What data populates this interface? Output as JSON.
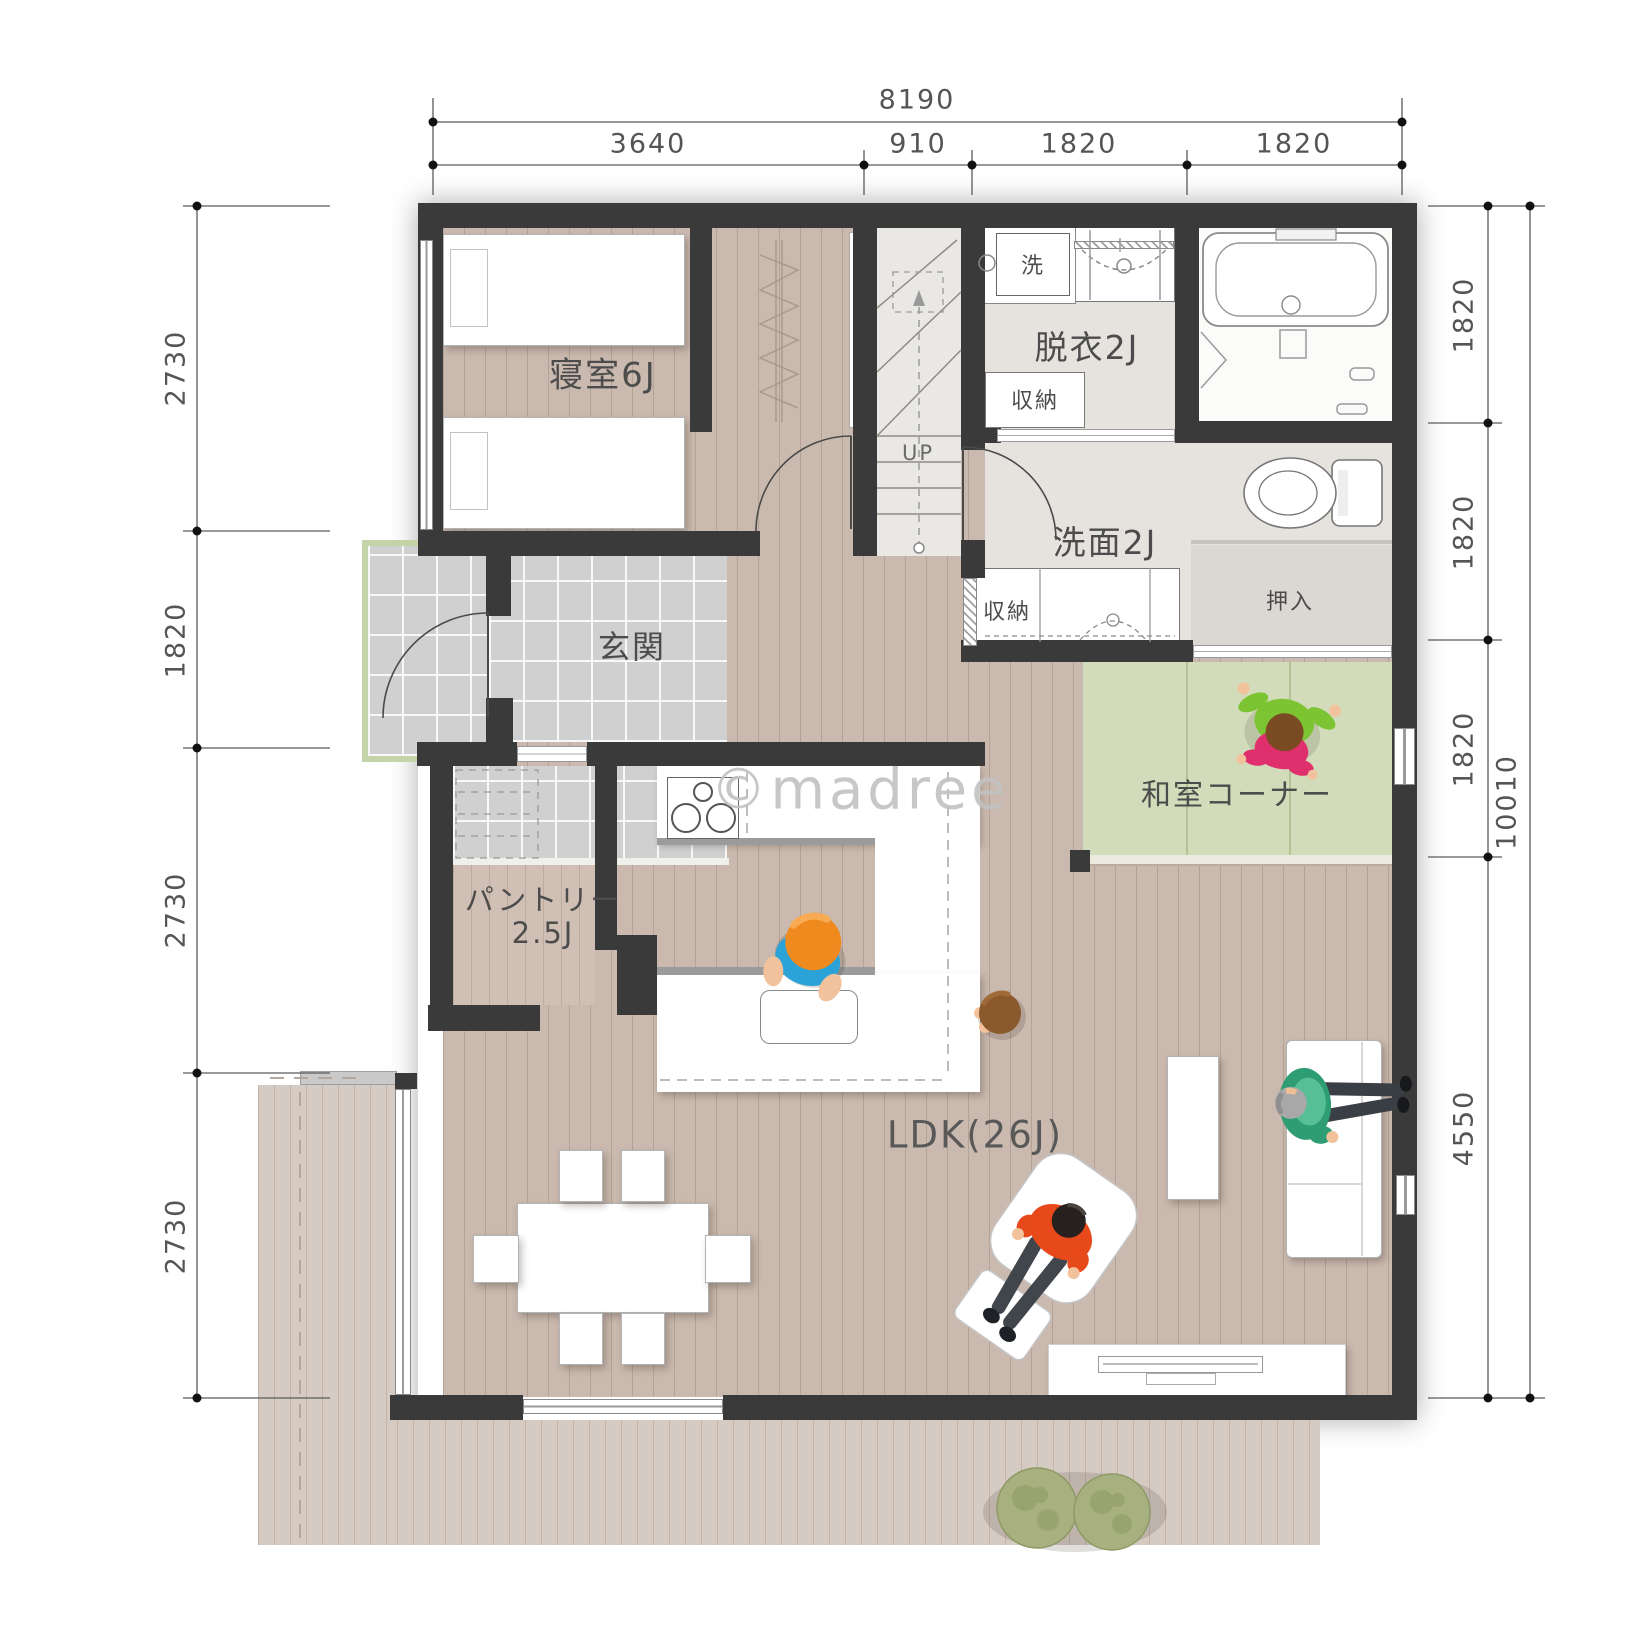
{
  "watermark": "©madree",
  "rooms": {
    "bedroom": {
      "label": "寝室6J"
    },
    "datsui": {
      "label": "脱衣2J"
    },
    "senmen": {
      "label": "洗面2J"
    },
    "genkan": {
      "label": "玄関"
    },
    "pantry": {
      "label_line1": "パントリー",
      "label_line2": "2.5J"
    },
    "washitsu": {
      "label": "和室コーナー"
    },
    "ldk": {
      "label": "LDK(26J)"
    },
    "oshiire": {
      "label": "押入"
    },
    "storage_datsui": {
      "label": "収納"
    },
    "storage_senmen": {
      "label": "収納"
    },
    "stairs": {
      "label": "UP"
    },
    "laundry": {
      "label": "洗"
    }
  },
  "dimensions": {
    "top_total": "8190",
    "top_segments": [
      "3640",
      "910",
      "1820",
      "1820"
    ],
    "left_segments": [
      "2730",
      "1820",
      "2730",
      "2730"
    ],
    "right_segments": [
      "1820",
      "1820",
      "1820",
      "4550"
    ],
    "right_total": "10010"
  },
  "colors": {
    "wall": "#3a3a3a",
    "wood_floor": "#cab9ae",
    "deck": "#d6cbc2",
    "tile": "#d0d0d0",
    "tatami": "#d3dcba",
    "accent_orange": "#ee8a1e",
    "accent_blue": "#2ba3d8",
    "accent_red": "#e8491b",
    "accent_green": "#7cc431",
    "accent_pink": "#df2f6d",
    "accent_teal": "#2f9d74"
  }
}
